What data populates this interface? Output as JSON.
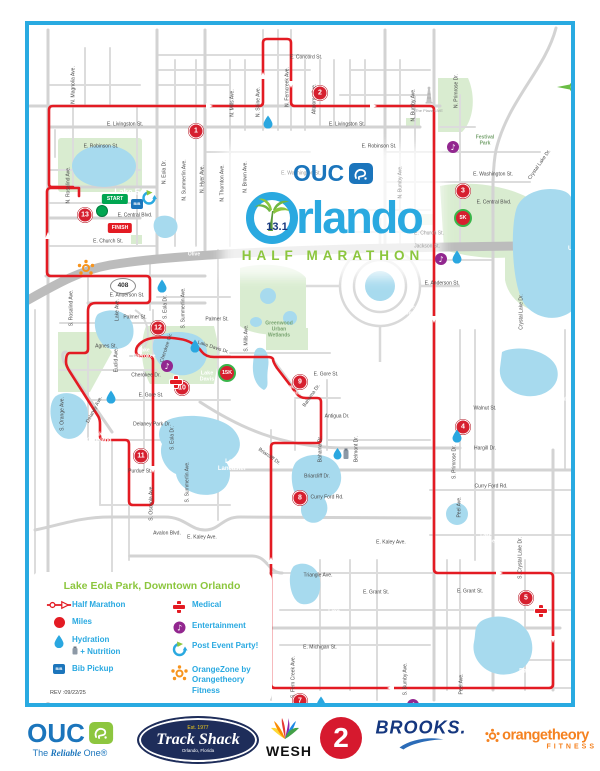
{
  "poster": {
    "brand": "OUC",
    "distance": "13.1",
    "city": "Orlando",
    "subtitle": "HALF MARATHON"
  },
  "map": {
    "compass": {
      "label": "N",
      "x": 546,
      "y": 58
    },
    "shield": {
      "text": "408",
      "x": 94,
      "y": 261
    },
    "start": {
      "label": "START",
      "x": 86,
      "y": 174,
      "dot_x": 73,
      "dot_y": 186
    },
    "finish": {
      "label": "FINISH",
      "x": 91,
      "y": 203
    },
    "bib_label": "BIB",
    "street_labels": [
      {
        "t": "E. Concord St.",
        "x": 277,
        "y": 33
      },
      {
        "t": "E. Livingston St.",
        "x": 96,
        "y": 100
      },
      {
        "t": "E. Livingston St.",
        "x": 318,
        "y": 100
      },
      {
        "t": "E. Robinson St.",
        "x": 72,
        "y": 122
      },
      {
        "t": "E. Robinson St.",
        "x": 350,
        "y": 122
      },
      {
        "t": "E. Washington St.",
        "x": 272,
        "y": 149,
        "c": "#9a9a9a"
      },
      {
        "t": "E. Washington St.",
        "x": 464,
        "y": 150
      },
      {
        "t": "E. Central Blvd.",
        "x": 106,
        "y": 191
      },
      {
        "t": "E. Central Blvd.",
        "x": 465,
        "y": 178
      },
      {
        "t": "E. Church St.",
        "x": 79,
        "y": 217
      },
      {
        "t": "E. Church St.",
        "x": 400,
        "y": 209,
        "c": "#9a9a9a"
      },
      {
        "t": "Jackson St.",
        "x": 398,
        "y": 222,
        "c": "#9a9a9a"
      },
      {
        "t": "E. Anderson St.",
        "x": 98,
        "y": 271
      },
      {
        "t": "E. Anderson St.",
        "x": 413,
        "y": 259
      },
      {
        "t": "Palmer St.",
        "x": 106,
        "y": 293
      },
      {
        "t": "Palmer St.",
        "x": 188,
        "y": 295
      },
      {
        "t": "Agnes St.",
        "x": 77,
        "y": 322
      },
      {
        "t": "Cherokee Dr.",
        "x": 117,
        "y": 351
      },
      {
        "t": "E. Gore St.",
        "x": 122,
        "y": 371
      },
      {
        "t": "E. Gore St.",
        "x": 297,
        "y": 350
      },
      {
        "t": "Delaney Park Dr.",
        "x": 123,
        "y": 400
      },
      {
        "t": "Purdue St.",
        "x": 111,
        "y": 447
      },
      {
        "t": "Avalon Blvd.",
        "x": 138,
        "y": 509
      },
      {
        "t": "E. Kaley Ave.",
        "x": 173,
        "y": 513
      },
      {
        "t": "E. Kaley Ave.",
        "x": 362,
        "y": 518
      },
      {
        "t": "Briarcliff Dr.",
        "x": 288,
        "y": 452
      },
      {
        "t": "Briarcliff Dr.",
        "x": 240,
        "y": 432,
        "r": 35
      },
      {
        "t": "Walnut St.",
        "x": 456,
        "y": 384
      },
      {
        "t": "Hargill Dr.",
        "x": 456,
        "y": 424
      },
      {
        "t": "Curry Ford Rd.",
        "x": 462,
        "y": 462
      },
      {
        "t": "Curry Ford Rd.",
        "x": 298,
        "y": 473
      },
      {
        "t": "Triangle Ave.",
        "x": 289,
        "y": 551
      },
      {
        "t": "E. Grant St.",
        "x": 347,
        "y": 568
      },
      {
        "t": "E. Grant St.",
        "x": 441,
        "y": 567
      },
      {
        "t": "E. Michigan St.",
        "x": 291,
        "y": 623
      },
      {
        "t": "Raeford Rd.",
        "x": 534,
        "y": 694
      },
      {
        "t": "Antigua Dr.",
        "x": 308,
        "y": 392
      },
      {
        "t": "The Plaza LIVE",
        "x": 400,
        "y": 86,
        "s": 4,
        "c": "#9a9a9a"
      },
      {
        "t": "N. Magnolia Ave.",
        "x": 45,
        "y": 60,
        "r": -90
      },
      {
        "t": "N. Rosalind Ave.",
        "x": 40,
        "y": 160,
        "r": -90
      },
      {
        "t": "S. Rosalind Ave.",
        "x": 43,
        "y": 283,
        "r": -90
      },
      {
        "t": "S. Orange Ave.",
        "x": 34,
        "y": 389,
        "r": -90
      },
      {
        "t": "N. Eola Dr.",
        "x": 136,
        "y": 147,
        "r": -90
      },
      {
        "t": "N. Summerlin Ave.",
        "x": 156,
        "y": 155,
        "r": -90
      },
      {
        "t": "N. Hyer Ave.",
        "x": 174,
        "y": 154,
        "r": -90
      },
      {
        "t": "N. Thornton Ave.",
        "x": 194,
        "y": 158,
        "r": -90
      },
      {
        "t": "N. Brown Ave.",
        "x": 217,
        "y": 152,
        "r": -90
      },
      {
        "t": "N. Mills Ave.",
        "x": 204,
        "y": 78,
        "r": -90
      },
      {
        "t": "S. Mills Ave.",
        "x": 218,
        "y": 313,
        "r": -90
      },
      {
        "t": "N. Shine Ave.",
        "x": 230,
        "y": 77,
        "r": -90
      },
      {
        "t": "N. Ferncreek Ave.",
        "x": 259,
        "y": 62,
        "r": -90
      },
      {
        "t": "Altaloma Ave.",
        "x": 286,
        "y": 74,
        "r": -90
      },
      {
        "t": "N. Bumby Ave.",
        "x": 385,
        "y": 80,
        "r": -90
      },
      {
        "t": "N. Bumby Ave.",
        "x": 372,
        "y": 157,
        "r": -90,
        "c": "#9a9a9a"
      },
      {
        "t": "S. Bumby Ave.",
        "x": 377,
        "y": 654,
        "r": -90
      },
      {
        "t": "N. Primrose Dr.",
        "x": 428,
        "y": 66,
        "r": -90
      },
      {
        "t": "S. Primrose Dr.",
        "x": 426,
        "y": 437,
        "r": -90
      },
      {
        "t": "Peel Ave.",
        "x": 431,
        "y": 482,
        "r": -90
      },
      {
        "t": "Peel Ave.",
        "x": 433,
        "y": 659,
        "r": -90
      },
      {
        "t": "S. Crystal Lake Dr.",
        "x": 492,
        "y": 533,
        "r": -90
      },
      {
        "t": "Conway Gardens Rd.",
        "x": 561,
        "y": 644,
        "r": -90
      },
      {
        "t": "S. Fern Creek Ave.",
        "x": 265,
        "y": 652,
        "r": -90
      },
      {
        "t": "S. Osceola Ave.",
        "x": 123,
        "y": 478,
        "r": -90
      },
      {
        "t": "S. Summerlin Ave.",
        "x": 155,
        "y": 283,
        "r": -90
      },
      {
        "t": "S. Summerlin Ave.",
        "x": 159,
        "y": 457,
        "r": -90
      },
      {
        "t": "S. Eola Dr.",
        "x": 137,
        "y": 282,
        "r": -90
      },
      {
        "t": "S. Eola Dr.",
        "x": 144,
        "y": 413,
        "r": -90
      },
      {
        "t": "Lake Ave.",
        "x": 89,
        "y": 285,
        "r": -90
      },
      {
        "t": "Euclid Ave.",
        "x": 88,
        "y": 335,
        "r": -90
      },
      {
        "t": "Bahama Dr.",
        "x": 292,
        "y": 424,
        "r": -90
      },
      {
        "t": "Belmont Dr.",
        "x": 328,
        "y": 424,
        "r": -90
      },
      {
        "t": "Crystal Lake Dr.",
        "x": 511,
        "y": 140,
        "r": -55
      },
      {
        "t": "Crystal Lake Dr.",
        "x": 493,
        "y": 287,
        "r": -90
      },
      {
        "t": "Delaney Ave.",
        "x": 66,
        "y": 385,
        "r": -62
      },
      {
        "t": "Lake Davis Dr.",
        "x": 184,
        "y": 323,
        "r": 18
      },
      {
        "t": "Bahama Dr.",
        "x": 283,
        "y": 371,
        "r": -55
      },
      {
        "t": "Cherokee Cir.",
        "x": 138,
        "y": 323,
        "r": -72
      }
    ],
    "lake_labels": [
      {
        "t": "Lake Eola",
        "x": 104,
        "y": 167,
        "s": 8
      },
      {
        "t": "Lake\nOlive",
        "x": 165,
        "y": 227,
        "s": 5
      },
      {
        "t": "Lake\nUnderhill",
        "x": 552,
        "y": 221,
        "s": 6
      },
      {
        "t": "Lake\nComo",
        "x": 380,
        "y": 286,
        "s": 5
      },
      {
        "t": "Lake\nCherokee",
        "x": 115,
        "y": 329,
        "s": 5
      },
      {
        "t": "Lake\nDavis",
        "x": 178,
        "y": 352,
        "s": 5.5
      },
      {
        "t": "Lake\nWeldona",
        "x": 262,
        "y": 366,
        "s": 5
      },
      {
        "t": "Lake\nCopeland",
        "x": 70,
        "y": 413,
        "s": 5.5
      },
      {
        "t": "Lake\nLancaster",
        "x": 203,
        "y": 441,
        "s": 6
      },
      {
        "t": "Hourglass\nLake",
        "x": 315,
        "y": 487,
        "s": 5.5
      },
      {
        "t": "Crystal\nLake",
        "x": 305,
        "y": 584,
        "s": 5
      },
      {
        "t": "Lake\nTerrace",
        "x": 457,
        "y": 514,
        "s": 5
      },
      {
        "t": "Lake\nArnold",
        "x": 529,
        "y": 372,
        "s": 5.5
      },
      {
        "t": "Bass Lake",
        "x": 505,
        "y": 647,
        "s": 6
      }
    ],
    "park_labels": [
      {
        "t": "Festival\nPark",
        "x": 456,
        "y": 116
      },
      {
        "t": "Greenwood\nUrban\nWetlands",
        "x": 250,
        "y": 305
      }
    ],
    "mile_markers": [
      {
        "n": "1",
        "x": 167,
        "y": 106
      },
      {
        "n": "2",
        "x": 291,
        "y": 68
      },
      {
        "n": "3",
        "x": 434,
        "y": 166
      },
      {
        "n": "4",
        "x": 434,
        "y": 402
      },
      {
        "n": "5",
        "x": 497,
        "y": 573
      },
      {
        "n": "6",
        "x": 502,
        "y": 688
      },
      {
        "n": "7",
        "x": 271,
        "y": 676
      },
      {
        "n": "8",
        "x": 271,
        "y": 473
      },
      {
        "n": "9",
        "x": 271,
        "y": 357
      },
      {
        "n": "10",
        "x": 153,
        "y": 363
      },
      {
        "n": "11",
        "x": 112,
        "y": 431
      },
      {
        "n": "12",
        "x": 129,
        "y": 303
      },
      {
        "n": "13",
        "x": 56,
        "y": 190
      }
    ],
    "checkpoints": [
      {
        "n": "5K",
        "x": 434,
        "y": 193
      },
      {
        "n": "10K",
        "x": 454,
        "y": 687
      },
      {
        "n": "15K",
        "x": 198,
        "y": 348
      }
    ],
    "icons": [
      {
        "type": "droplet",
        "x": 239,
        "y": 97
      },
      {
        "type": "droplet",
        "x": 428,
        "y": 232
      },
      {
        "type": "droplet",
        "x": 133,
        "y": 261
      },
      {
        "type": "droplet",
        "x": 166,
        "y": 321
      },
      {
        "type": "droplet",
        "x": 82,
        "y": 372
      },
      {
        "type": "droplet",
        "x": 428,
        "y": 411
      },
      {
        "type": "droplet",
        "x": 292,
        "y": 678
      },
      {
        "type": "droplet",
        "x": 547,
        "y": 636
      },
      {
        "type": "hydration_nutrition",
        "x": 312,
        "y": 429
      },
      {
        "type": "entertainment",
        "x": 424,
        "y": 122
      },
      {
        "type": "entertainment",
        "x": 412,
        "y": 234
      },
      {
        "type": "entertainment",
        "x": 138,
        "y": 341
      },
      {
        "type": "entertainment",
        "x": 384,
        "y": 680
      },
      {
        "type": "medical",
        "x": 147,
        "y": 357
      },
      {
        "type": "medical",
        "x": 512,
        "y": 586
      },
      {
        "type": "orangezone",
        "x": 57,
        "y": 243
      },
      {
        "type": "party",
        "x": 120,
        "y": 173
      },
      {
        "type": "bib",
        "x": 108,
        "y": 179
      },
      {
        "type": "tower",
        "x": 400,
        "y": 71
      }
    ]
  },
  "legend": {
    "title": "Lake Eola Park, Downtown Orlando",
    "rev": "REV :09/22/25",
    "columns": [
      [
        {
          "icon": "route",
          "lines": [
            "Half Marathon"
          ]
        },
        {
          "icon": "mile",
          "lines": [
            "Miles"
          ]
        },
        {
          "icon": "droplet",
          "lines": [
            "Hydration",
            "+ Nutrition"
          ]
        },
        {
          "icon": "bib",
          "lines": [
            "Bib Pickup"
          ]
        }
      ],
      [
        {
          "icon": "medical",
          "lines": [
            "Medical"
          ]
        },
        {
          "icon": "entertainment",
          "lines": [
            "Entertainment"
          ]
        },
        {
          "icon": "party",
          "lines": [
            "Post Event Party!"
          ]
        },
        {
          "icon": "orangezone",
          "lines": [
            "OrangeZone by",
            "Orangetheory Fitness"
          ]
        }
      ]
    ]
  },
  "sponsors": {
    "ouc": {
      "name": "OUC",
      "tagline": "The Reliable One®"
    },
    "trackshack": {
      "est": "Est. 1977",
      "name": "Track Shack",
      "city": "Orlando, Florida"
    },
    "wesh": {
      "name": "WESH",
      "channel": "2"
    },
    "brooks": {
      "name": "BROOKS."
    },
    "orangetheory": {
      "name": "orangetheory",
      "reg": "®",
      "sub": "FITNESS"
    }
  },
  "colors": {
    "frame_blue": "#29aae1",
    "route_red": "#e31b23",
    "marker_red": "#d6202f",
    "checkpoint_green": "#39b54a",
    "water_blue": "#a7daee",
    "park_green": "#d9ecd0",
    "title_blue": "#2aa9e0",
    "title_green": "#8cc63e",
    "legend_blue": "#29a9e1",
    "ouc_blue": "#1b75bc",
    "orange": "#f7941d",
    "purple": "#92278f",
    "start_green": "#00a651"
  }
}
